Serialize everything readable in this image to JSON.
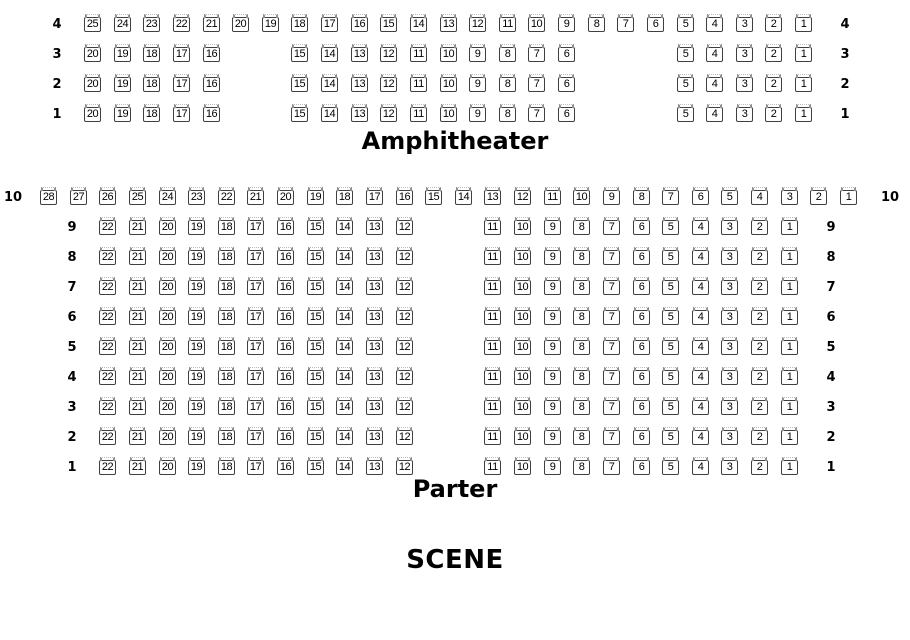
{
  "titles": {
    "amphitheater": "Amphitheater",
    "parter": "Parter",
    "scene": "SCENE"
  },
  "colors": {
    "background": "#ffffff",
    "seat_border": "#3f3f3f",
    "seat_back_mark": "#8f8f8f",
    "text": "#000000"
  },
  "sections": [
    {
      "id": "amphitheater",
      "grid": {
        "x0": 84,
        "y0": 17,
        "col_pitch": 29.63,
        "row_pitch": 30
      },
      "rows": [
        {
          "label": "4",
          "segments": [
            {
              "col": 0,
              "seats": [
                25,
                24,
                23,
                22,
                21,
                20,
                19,
                18,
                17,
                16,
                15,
                14,
                13,
                12,
                11,
                10,
                9,
                8,
                7,
                6,
                5,
                4,
                3,
                2,
                1
              ]
            }
          ]
        },
        {
          "label": "3",
          "segments": [
            {
              "col": 0,
              "seats": [
                20,
                19,
                18,
                17,
                16
              ]
            },
            {
              "col": 7,
              "seats": [
                15,
                14,
                13,
                12,
                11,
                10,
                9,
                8,
                7,
                6
              ]
            },
            {
              "col": 20,
              "seats": [
                5,
                4,
                3,
                2,
                1
              ]
            }
          ]
        },
        {
          "label": "2",
          "segments": [
            {
              "col": 0,
              "seats": [
                20,
                19,
                18,
                17,
                16
              ]
            },
            {
              "col": 7,
              "seats": [
                15,
                14,
                13,
                12,
                11,
                10,
                9,
                8,
                7,
                6
              ]
            },
            {
              "col": 20,
              "seats": [
                5,
                4,
                3,
                2,
                1
              ]
            }
          ]
        },
        {
          "label": "1",
          "segments": [
            {
              "col": 0,
              "seats": [
                20,
                19,
                18,
                17,
                16
              ]
            },
            {
              "col": 7,
              "seats": [
                15,
                14,
                13,
                12,
                11,
                10,
                9,
                8,
                7,
                6
              ]
            },
            {
              "col": 20,
              "seats": [
                5,
                4,
                3,
                2,
                1
              ]
            }
          ]
        }
      ]
    },
    {
      "id": "parter",
      "grid": {
        "x0": 40,
        "y0": 190,
        "col_pitch": 29.63,
        "row_pitch": 30
      },
      "rows": [
        {
          "label": "10",
          "segments": [
            {
              "col": 0,
              "seats": [
                28,
                27,
                26,
                25,
                24,
                23,
                22,
                21,
                20,
                19,
                18,
                17,
                16,
                15,
                14,
                13,
                12,
                11,
                10,
                9,
                8,
                7,
                6,
                5,
                4,
                3,
                2,
                1
              ]
            }
          ]
        },
        {
          "label": "9",
          "segments": [
            {
              "col": 2,
              "seats": [
                22,
                21,
                20,
                19,
                18,
                17,
                16,
                15,
                14,
                13,
                12
              ]
            },
            {
              "col": 15,
              "seats": [
                11,
                10,
                9,
                8,
                7,
                6,
                5,
                4,
                3,
                2,
                1
              ]
            }
          ]
        },
        {
          "label": "8",
          "segments": [
            {
              "col": 2,
              "seats": [
                22,
                21,
                20,
                19,
                18,
                17,
                16,
                15,
                14,
                13,
                12
              ]
            },
            {
              "col": 15,
              "seats": [
                11,
                10,
                9,
                8,
                7,
                6,
                5,
                4,
                3,
                2,
                1
              ]
            }
          ]
        },
        {
          "label": "7",
          "segments": [
            {
              "col": 2,
              "seats": [
                22,
                21,
                20,
                19,
                18,
                17,
                16,
                15,
                14,
                13,
                12
              ]
            },
            {
              "col": 15,
              "seats": [
                11,
                10,
                9,
                8,
                7,
                6,
                5,
                4,
                3,
                2,
                1
              ]
            }
          ]
        },
        {
          "label": "6",
          "segments": [
            {
              "col": 2,
              "seats": [
                22,
                21,
                20,
                19,
                18,
                17,
                16,
                15,
                14,
                13,
                12
              ]
            },
            {
              "col": 15,
              "seats": [
                11,
                10,
                9,
                8,
                7,
                6,
                5,
                4,
                3,
                2,
                1
              ]
            }
          ]
        },
        {
          "label": "5",
          "segments": [
            {
              "col": 2,
              "seats": [
                22,
                21,
                20,
                19,
                18,
                17,
                16,
                15,
                14,
                13,
                12
              ]
            },
            {
              "col": 15,
              "seats": [
                11,
                10,
                9,
                8,
                7,
                6,
                5,
                4,
                3,
                2,
                1
              ]
            }
          ]
        },
        {
          "label": "4",
          "segments": [
            {
              "col": 2,
              "seats": [
                22,
                21,
                20,
                19,
                18,
                17,
                16,
                15,
                14,
                13,
                12
              ]
            },
            {
              "col": 15,
              "seats": [
                11,
                10,
                9,
                8,
                7,
                6,
                5,
                4,
                3,
                2,
                1
              ]
            }
          ]
        },
        {
          "label": "3",
          "segments": [
            {
              "col": 2,
              "seats": [
                22,
                21,
                20,
                19,
                18,
                17,
                16,
                15,
                14,
                13,
                12
              ]
            },
            {
              "col": 15,
              "seats": [
                11,
                10,
                9,
                8,
                7,
                6,
                5,
                4,
                3,
                2,
                1
              ]
            }
          ]
        },
        {
          "label": "2",
          "segments": [
            {
              "col": 2,
              "seats": [
                22,
                21,
                20,
                19,
                18,
                17,
                16,
                15,
                14,
                13,
                12
              ]
            },
            {
              "col": 15,
              "seats": [
                11,
                10,
                9,
                8,
                7,
                6,
                5,
                4,
                3,
                2,
                1
              ]
            }
          ]
        },
        {
          "label": "1",
          "segments": [
            {
              "col": 2,
              "seats": [
                22,
                21,
                20,
                19,
                18,
                17,
                16,
                15,
                14,
                13,
                12
              ]
            },
            {
              "col": 15,
              "seats": [
                11,
                10,
                9,
                8,
                7,
                6,
                5,
                4,
                3,
                2,
                1
              ]
            }
          ]
        }
      ]
    }
  ]
}
